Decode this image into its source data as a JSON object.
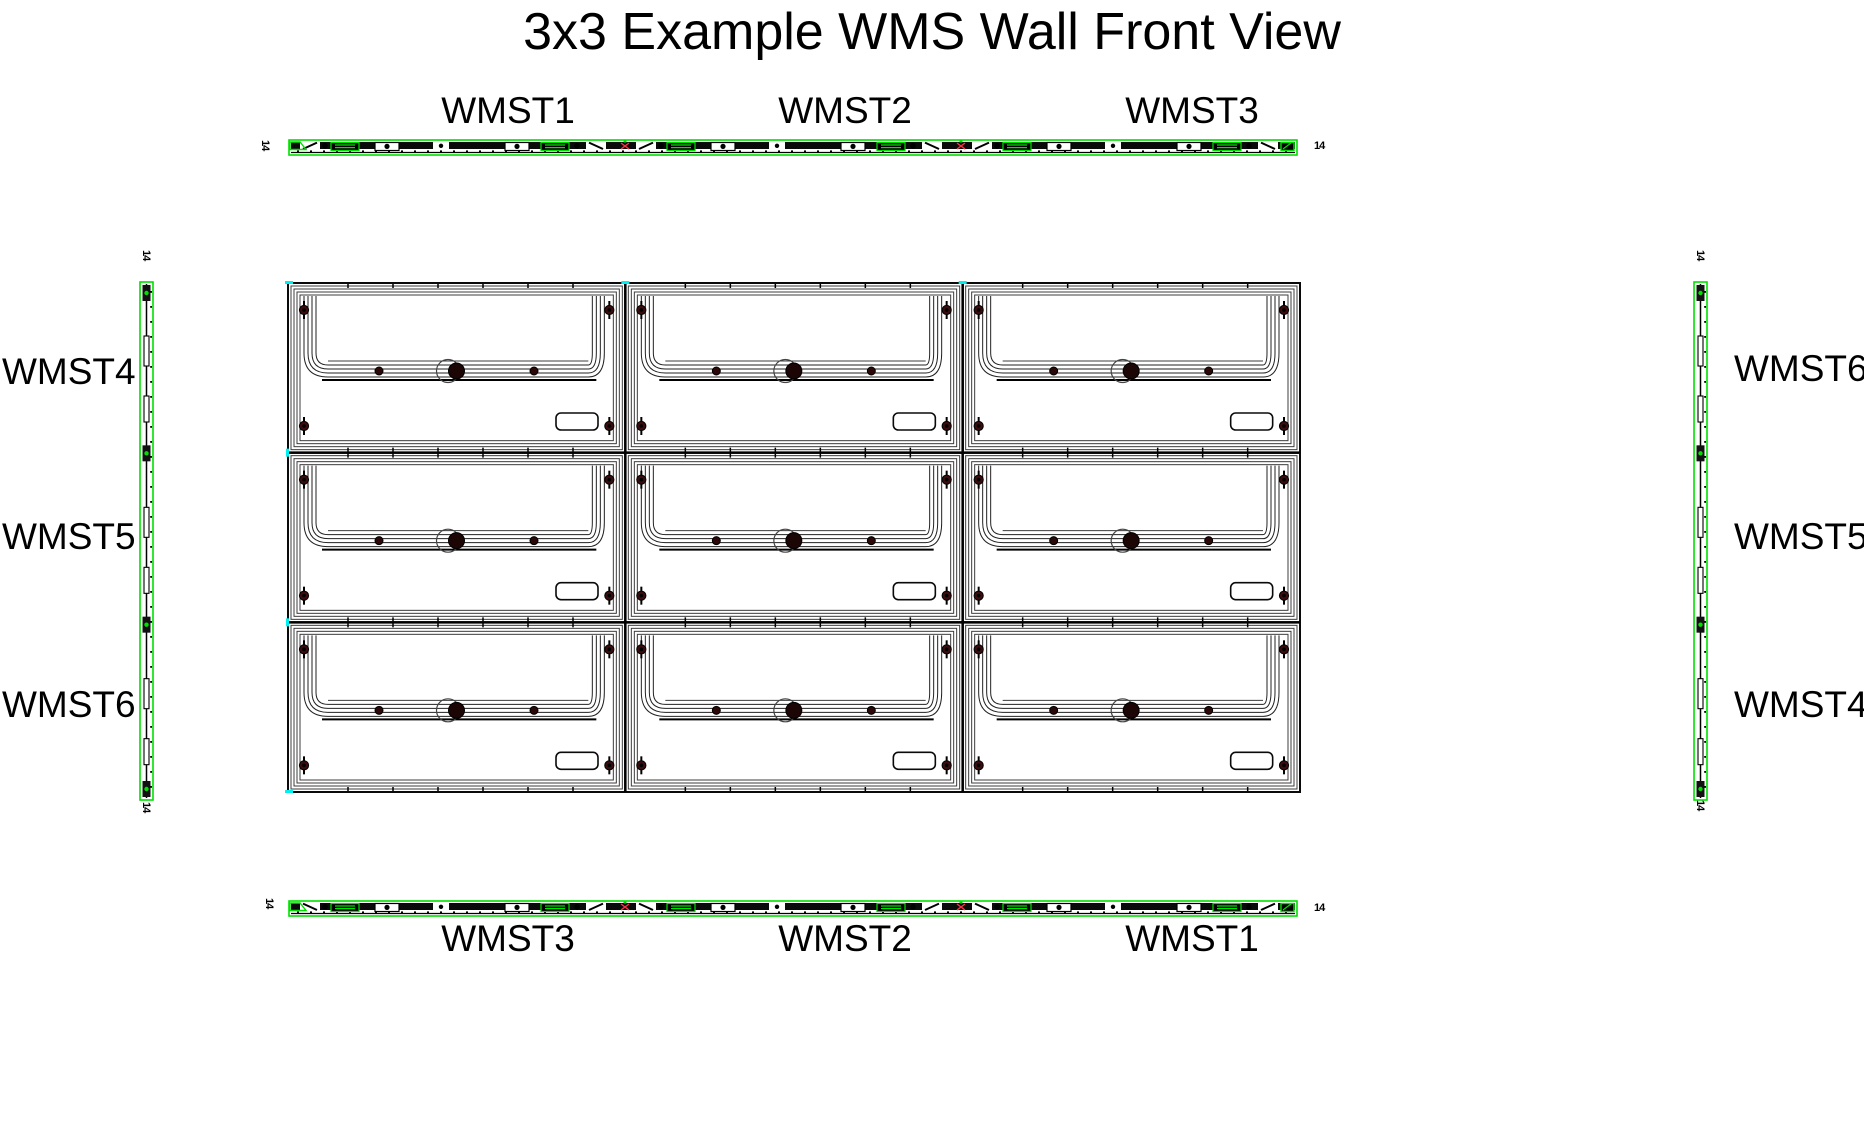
{
  "title": "3x3 Example WMS Wall Front View",
  "top_strip": {
    "labels": [
      "WMST1",
      "WMST2",
      "WMST3"
    ],
    "left_marker": "14",
    "right_marker": "14"
  },
  "bottom_strip": {
    "labels": [
      "WMST3",
      "WMST2",
      "WMST1"
    ],
    "left_marker": "14",
    "right_marker": "14"
  },
  "left_strip": {
    "labels": [
      "WMST4",
      "WMST5",
      "WMST6"
    ],
    "top_marker": "14",
    "bottom_marker": "14"
  },
  "right_strip": {
    "labels": [
      "WMST6",
      "WMST5",
      "WMST4"
    ],
    "top_marker": "14",
    "bottom_marker": "14"
  },
  "grid": {
    "rows": 3,
    "cols": 3,
    "description": "3x3 array of WMS wall-mount frame modules"
  },
  "colors": {
    "accent_green": "#00E000",
    "accent_cyan": "#00F0F0",
    "accent_red": "#FF3344",
    "bolt_maroon": "#3A0C0C",
    "line": "#151515",
    "line_light": "#3C3C3C"
  }
}
